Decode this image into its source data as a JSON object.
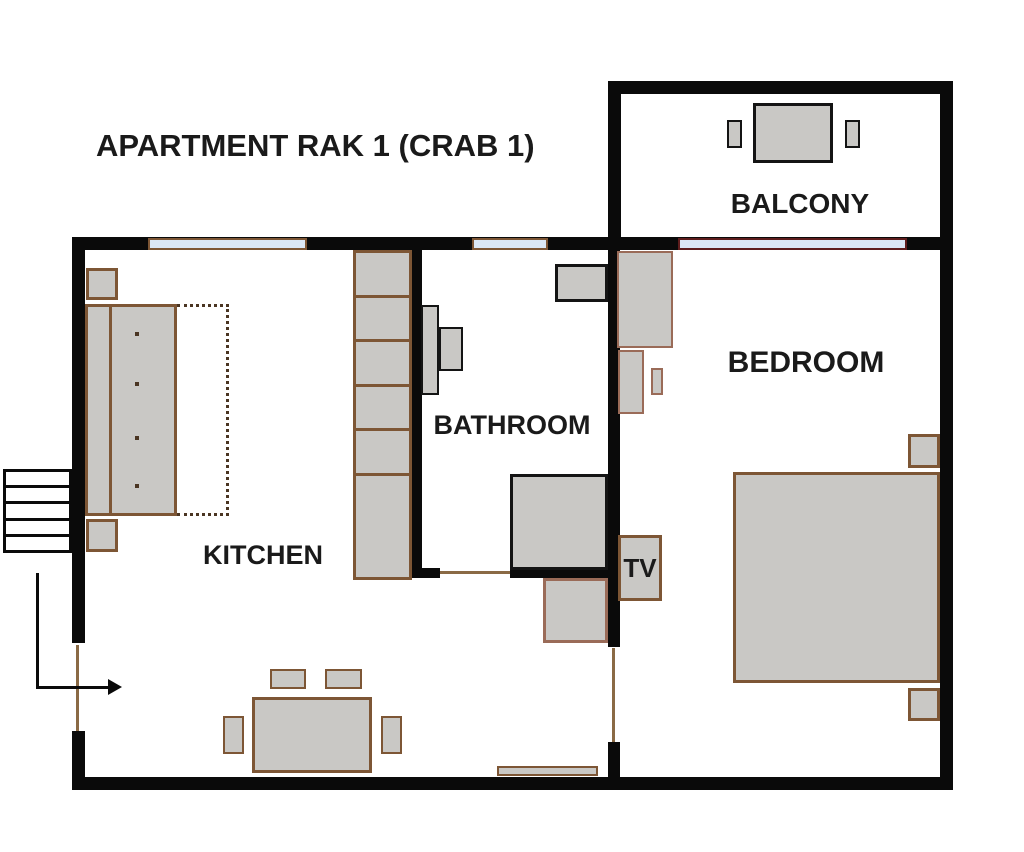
{
  "title": "APARTMENT RAK 1 (CRAB 1)",
  "rooms": {
    "balcony": {
      "label": "BALCONY"
    },
    "bathroom": {
      "label": "BATHROOM"
    },
    "kitchen": {
      "label": "KITCHEN"
    },
    "bedroom": {
      "label": "BEDROOM"
    },
    "tv": {
      "label": "TV"
    }
  },
  "palette": {
    "wall": "#0a0a0a",
    "furniture_fill": "#c9c8c5",
    "wood_border": "#7d5635",
    "rose_border": "#9a6b58",
    "dark_border": "#141414",
    "window_fill": "#dbe7f5",
    "window_frame": "#7d5635",
    "balcony_door_frame": "#5e1d1d",
    "door_line": "#8a6a45",
    "dotted_line": "#4a3522",
    "text": "#1a1a1a"
  }
}
